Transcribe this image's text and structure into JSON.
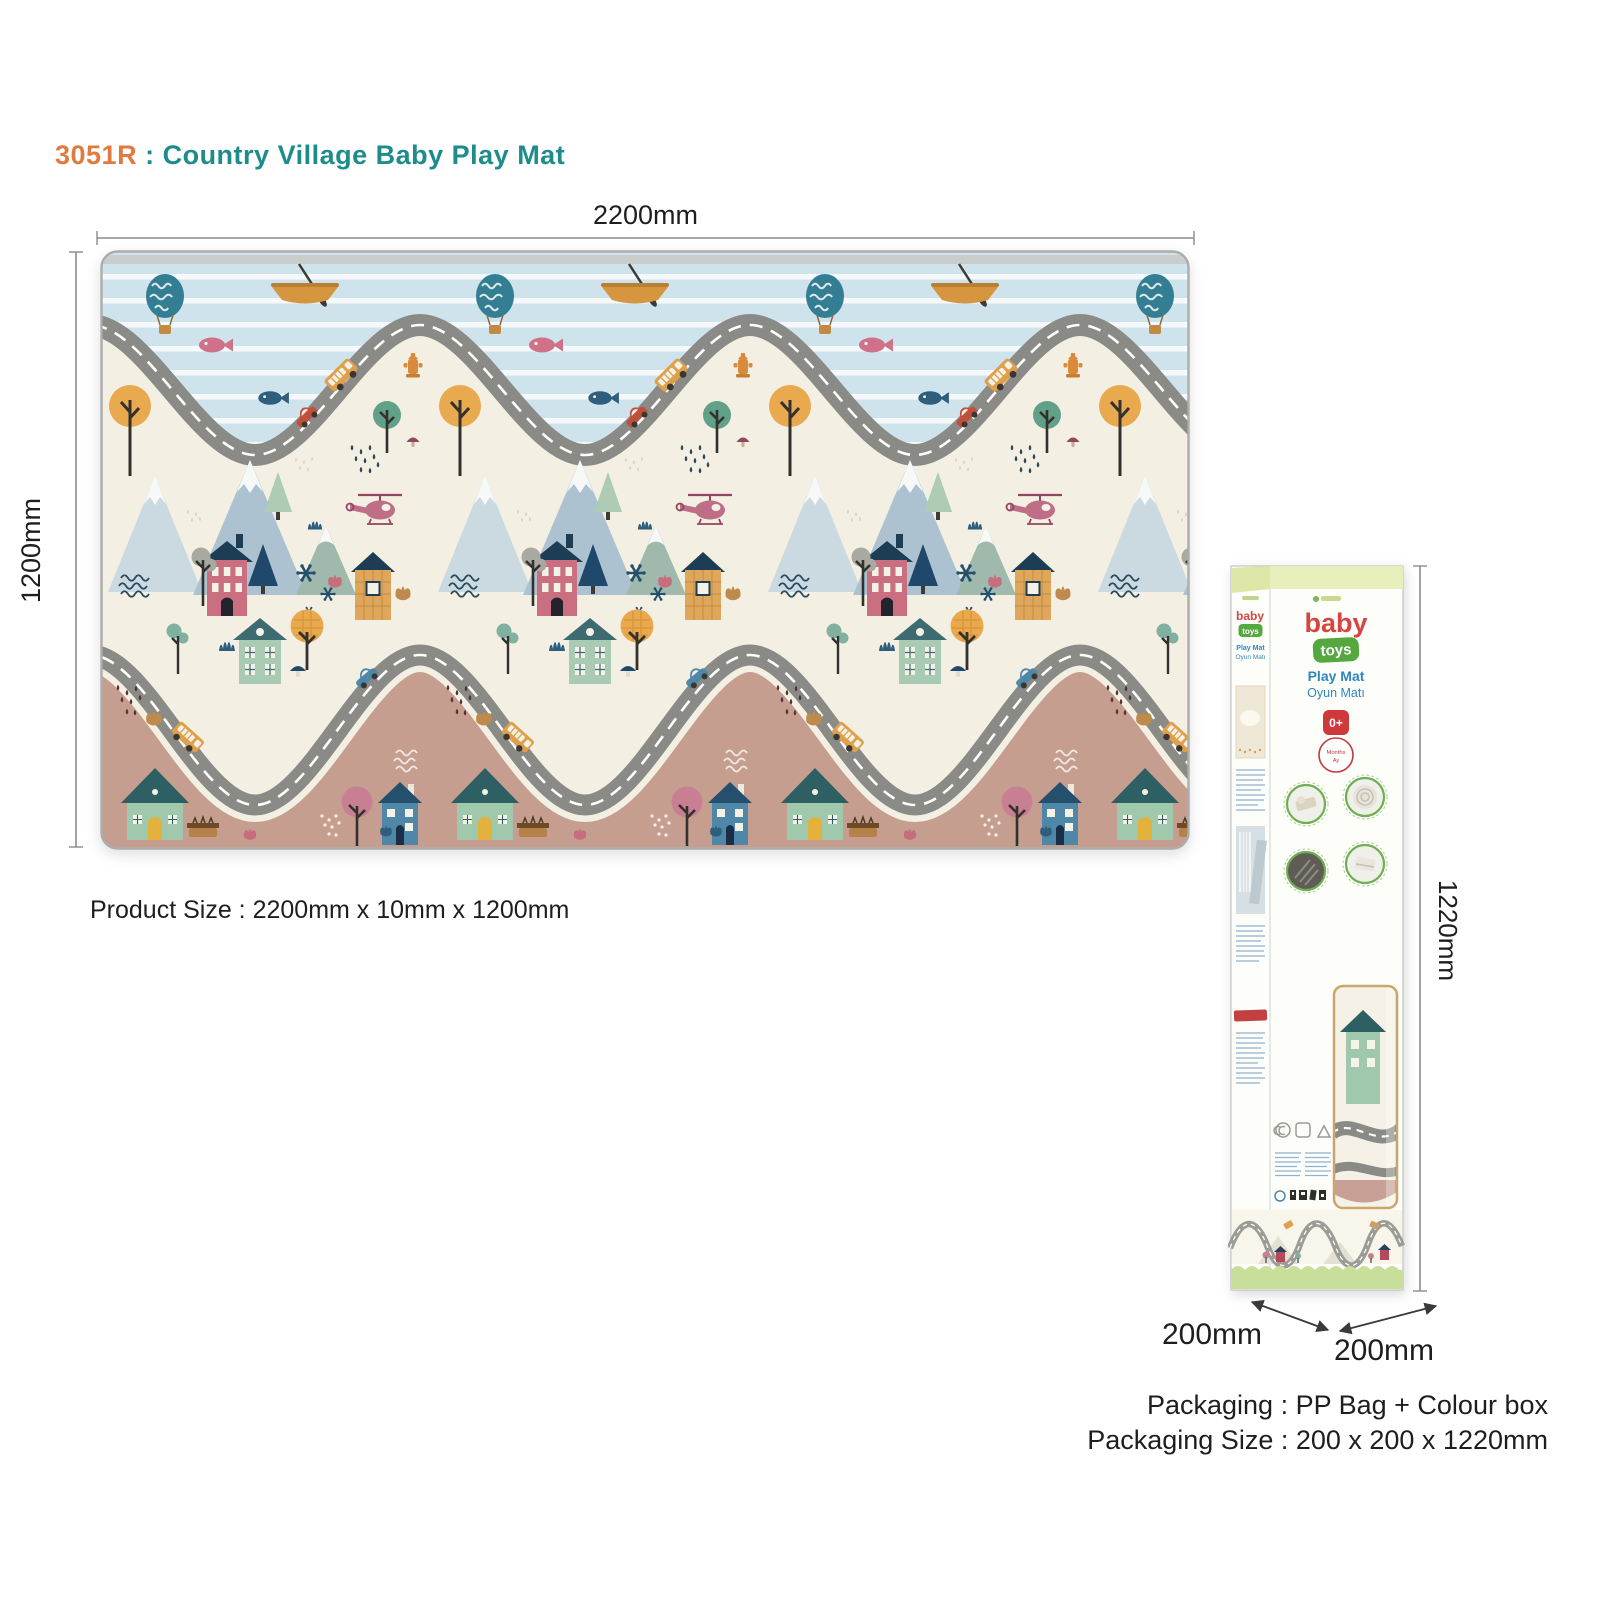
{
  "title": {
    "code": "3051R",
    "separator": " : ",
    "name": "Country Village Baby Play Mat"
  },
  "mat": {
    "width_label": "2200mm",
    "height_label": "1200mm",
    "product_size_label": "Product Size : 2200mm x 10mm x 1200mm",
    "motifs": [
      "hot-air-balloon",
      "rowing-boat",
      "pink-fish",
      "navy-fish",
      "winding-road",
      "school-bus",
      "red-car",
      "blue-car",
      "fire-hydrant",
      "snow-mountains",
      "pine-tree",
      "helicopter",
      "pink-house",
      "orange-house",
      "green-house",
      "blue-house",
      "orange-tree",
      "green-tree",
      "pink-tree",
      "snowflakes",
      "rain-drops",
      "flowers",
      "squiggle-waves"
    ]
  },
  "box": {
    "brand_line1": "baby",
    "brand_line2": "toys",
    "product_line1": "Play Mat",
    "product_line2": "Oyun Matı",
    "age_badge": "0+",
    "age_unit1": "Months",
    "age_unit2": "Ay",
    "height_label": "1220mm",
    "depth_label": "200mm",
    "width_label": "200mm"
  },
  "packaging": {
    "line1": "Packaging : PP Bag + Colour box",
    "line2": "Packaging Size : 200 x 200 x 1220mm"
  },
  "colors": {
    "title_code": "#E07A3F",
    "title_name": "#1F8C8C",
    "sky": "#CFE3EC",
    "cream": "#F3EFE3",
    "mauve": "#C69E90",
    "road_gray": "#8A8B87",
    "brand_red": "#D64541",
    "brand_green": "#55A83F",
    "brand_blue": "#2F86C0",
    "badge_red": "#D0393B",
    "box_top_green": "#E9EFBC",
    "grass_green": "#C8DF9B"
  }
}
